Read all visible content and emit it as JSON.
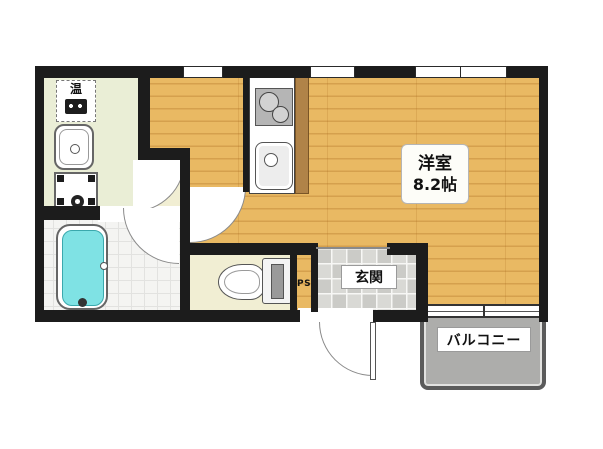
{
  "floor_plan": {
    "type": "apartment-floor-plan",
    "rooms": {
      "main_room": {
        "label": "洋室",
        "size": "8.2帖"
      },
      "entrance": {
        "label": "玄関"
      },
      "balcony": {
        "label": "バルコニー"
      },
      "pipe_space": {
        "label": "PS"
      },
      "water_heater_panel": {
        "label": "温"
      }
    },
    "fixtures": [
      "bathtub",
      "toilet",
      "washbasin",
      "washing-machine-pan",
      "water-heater-control",
      "kitchen-sink",
      "gas-stove",
      "kitchen-counter"
    ],
    "colors": {
      "wall": "#1c1c1c",
      "wood_floor": "#e9b963",
      "washroom_floor": "#eaeed6",
      "hall_floor": "#f1eed3",
      "bath_tile": "#f4f4f2",
      "entrance_tile": "#d2d2ce",
      "balcony": "#adadab",
      "bathtub_water": "#7fe2e4",
      "counter_strip": "#b08348"
    }
  }
}
